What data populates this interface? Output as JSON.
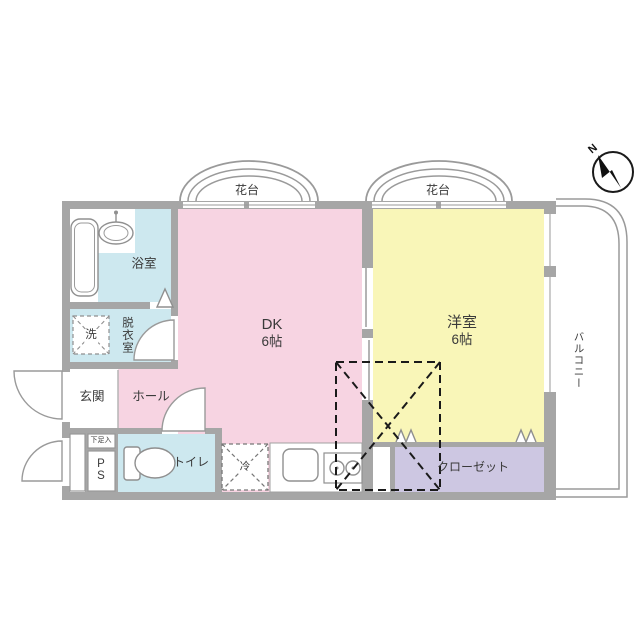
{
  "colors": {
    "dk_pink": "#f7d4e2",
    "western_yellow": "#f9f6b8",
    "wet_blue": "#cde8ef",
    "closet_purple": "#cdc7e2",
    "wall_gray": "#a6a6a6"
  },
  "compass": {
    "north_label": "N"
  },
  "plan": {
    "flower_stand_left": "花台",
    "flower_stand_right": "花台",
    "bathroom": "浴室",
    "laundry": "洗",
    "dressing_room": "脱衣室",
    "entrance": "玄関",
    "hall": "ホール",
    "shoe_box": "下足入",
    "pipe_space": "PS",
    "toilet": "トイレ",
    "refrigerator": "冷",
    "dk_name": "DK",
    "dk_size": "6帖",
    "western_room_name": "洋室",
    "western_room_size": "6帖",
    "closet": "クローゼット",
    "balcony": "バルコニー"
  }
}
